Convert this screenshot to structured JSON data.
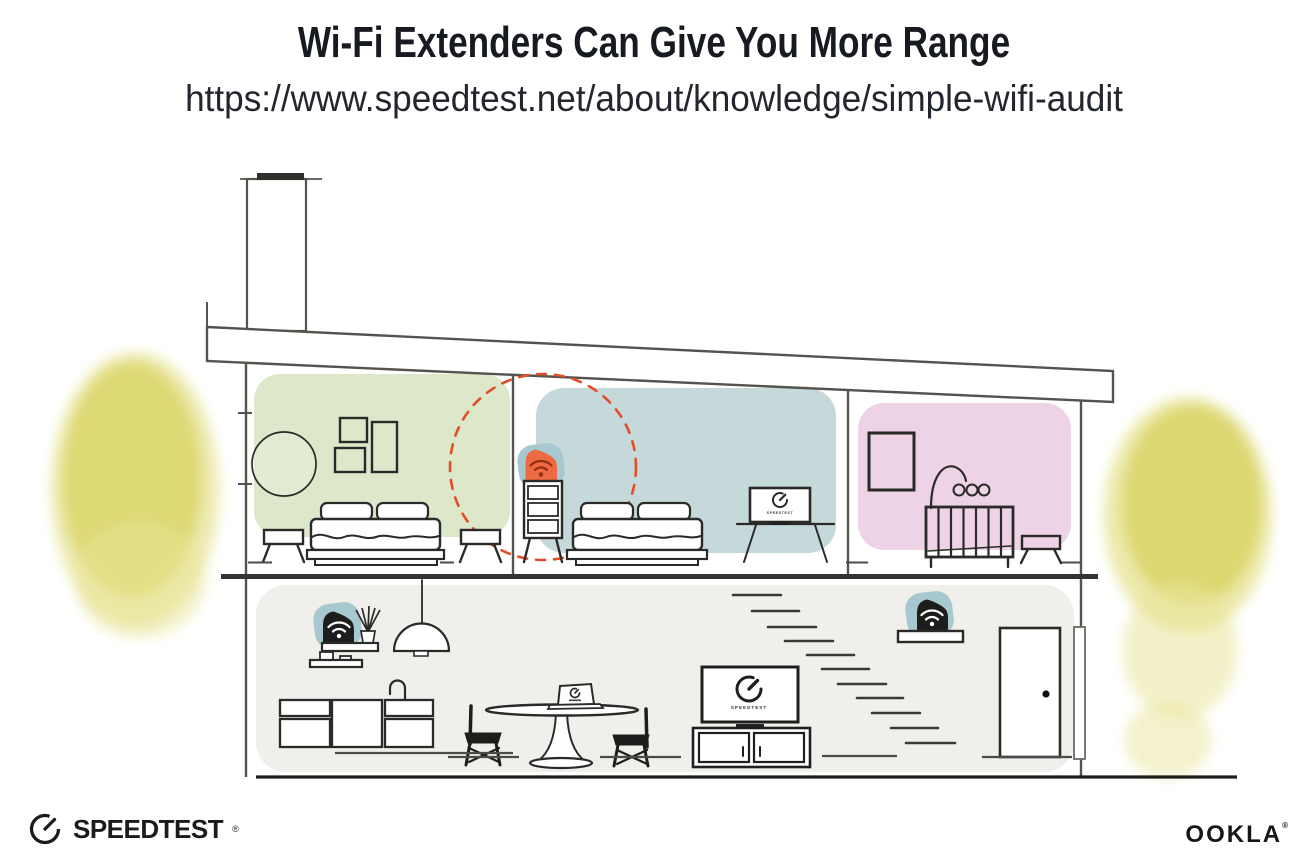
{
  "header": {
    "title": "Wi-Fi Extenders Can Give You More Range",
    "url": "https://www.speedtest.net/about/knowledge/simple-wifi-audit"
  },
  "branding": {
    "speedtest_logo_text": "SPEEDTEST",
    "speedtest_trademark": "®",
    "ookla_logo_text": "OOKLA",
    "ookla_trademark": "®"
  },
  "illustration": {
    "bedroom_tv_label": "SPEEDTEST",
    "living_room_tv_label": "SPEEDTEST",
    "icons": {
      "speedtest_gauge": "gauge-icon",
      "wifi_extender": "wifi-icon",
      "wifi_router": "wifi-icon"
    }
  },
  "colors": {
    "ink": "#171a21",
    "url_ink": "#23262e",
    "line": "#5a5850",
    "furniture": "#2a2a28",
    "room_green": "#dde7ca",
    "room_blue": "#c5d8da",
    "room_pink": "#eed3e6",
    "room_gray": "#f0efeb",
    "halo_teal": "#a6c8ce",
    "extender_orange": "#ee6a42",
    "wifi_deep_orange": "#952f12",
    "device_black": "#1d1d1b",
    "coverage_dash": "#e14e28",
    "foliage_yellow": "#dbd66a",
    "foliage_soft": "#e9e69c",
    "floor_dark": "#33332f",
    "logo_ink": "#1b1b1d"
  }
}
